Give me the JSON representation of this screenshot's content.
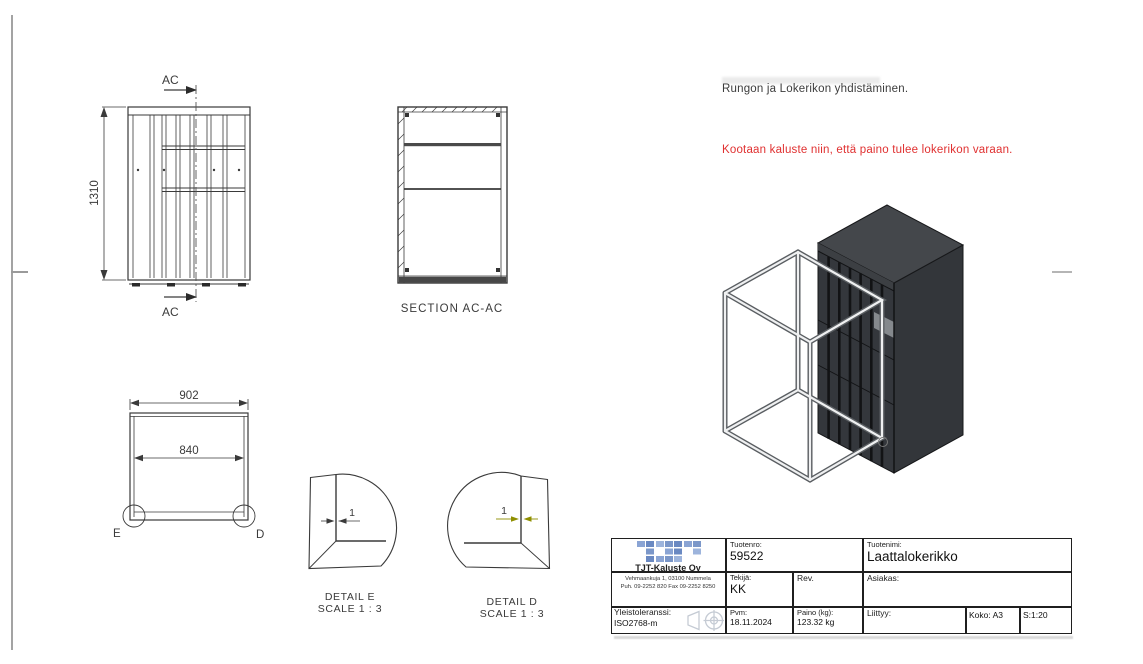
{
  "notes": {
    "assembly": "Rungon ja Lokerikon yhdistäminen.",
    "warning": "Kootaan kaluste niin, että paino tulee lokerikon varaan."
  },
  "colors": {
    "warning_red": "#e03030",
    "logo_blue": "#7b97c9",
    "detail_d_dim_olive": "#8f8f00",
    "locker_gray": "#34373c",
    "drawing_line": "#3a3a3a"
  },
  "front_view": {
    "height_dim": "1310",
    "section_mark": "AC"
  },
  "section_view": {
    "label": "SECTION AC-AC"
  },
  "top_view": {
    "width_dim": "902",
    "inner_width_dim": "840",
    "detail_mark_e": "E",
    "detail_mark_d": "D"
  },
  "detail_e": {
    "title": "DETAIL E",
    "scale": "SCALE 1 : 3",
    "dim": "1"
  },
  "detail_d": {
    "title": "DETAIL D",
    "scale": "SCALE 1 : 3",
    "dim": "1"
  },
  "title_block": {
    "company_name": "TJT-Kaluste Oy",
    "company_address": "Vehmaankuja 1, 03100 Nummela",
    "company_phone": "Puh. 09-2252 820  Fax 09-2252 8250",
    "tolerance_label": "Yleistoleranssi:",
    "tolerance_value": "ISO2768-m",
    "product_no_label": "Tuotenro:",
    "product_no_value": "59522",
    "product_name_label": "Tuotenimi:",
    "product_name_value": "Laattalokerikko",
    "author_label": "Tekijä:",
    "author_value": "KK",
    "rev_label": "Rev.",
    "customer_label": "Asiakas:",
    "date_label": "Pvm:",
    "date_value": "18.11.2024",
    "weight_label": "Paino (kg):",
    "weight_value": "123.32 kg",
    "related_label": "Liittyy:",
    "size_value": "Koko: A3",
    "scale_value": "S:1:20"
  }
}
